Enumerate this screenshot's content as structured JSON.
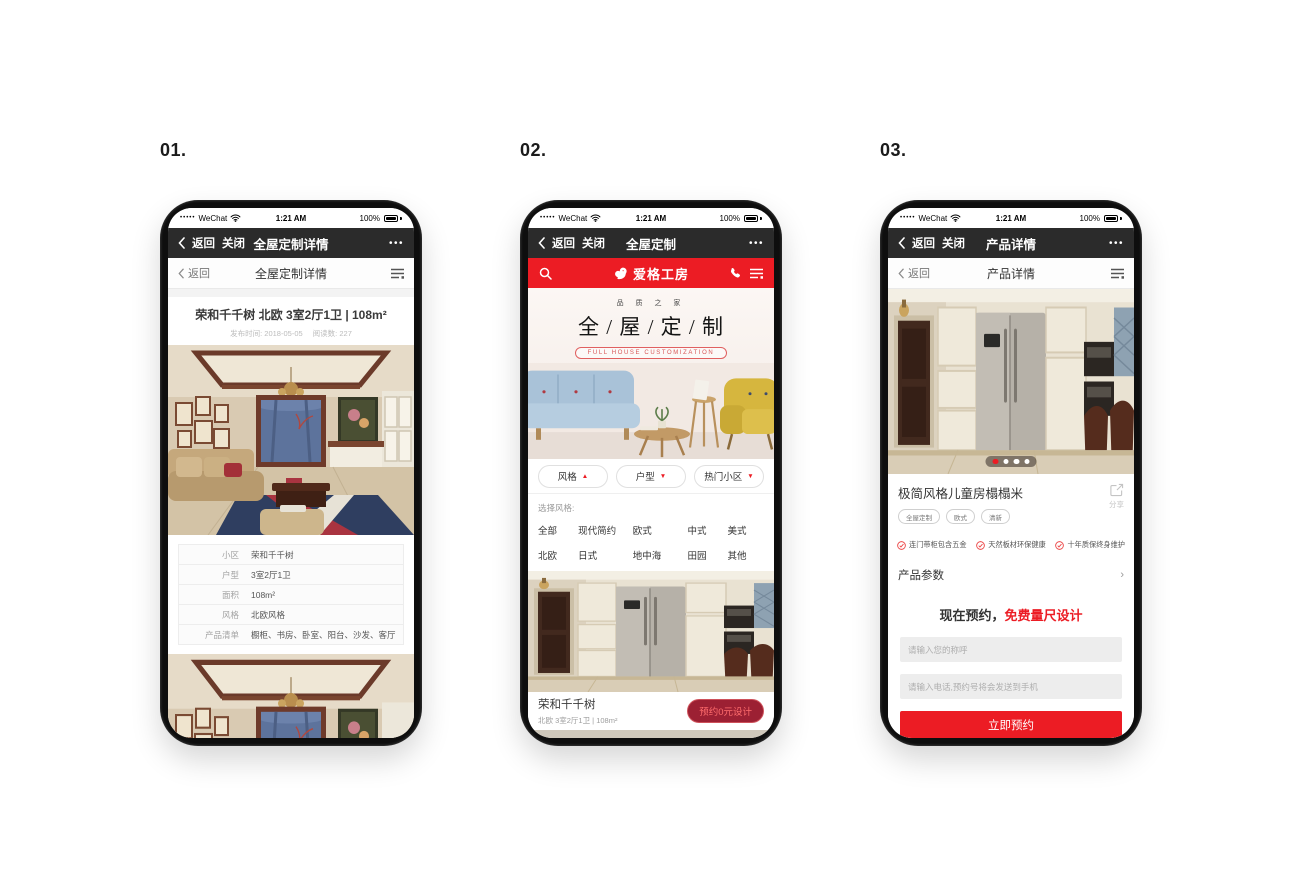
{
  "labels": {
    "phone1": "01.",
    "phone2": "02.",
    "phone3": "03."
  },
  "status_bar": {
    "signal_dots": "•••••",
    "carrier": "WeChat",
    "time": "1:21 AM",
    "battery_percent": "100%"
  },
  "icons": {
    "more": "•••",
    "chevron_right": "›"
  },
  "colors": {
    "brand_red": "#ec1c24",
    "nav_dark": "#2b2b2b",
    "deep_red": "#9c2033"
  },
  "phones": [
    {
      "wechat_nav": {
        "back": "返回",
        "close": "关闭",
        "title": "全屋定制详情"
      },
      "page_nav": {
        "back": "返回",
        "title": "全屋定制详情"
      },
      "article": {
        "title": "荣和千千树 北欧 3室2厅1卫 | 108m²",
        "publish_label": "发布时间:",
        "publish_date": "2018-05-05",
        "reads_label": "阅读数:",
        "reads_count": "227"
      },
      "info_table": {
        "rows": [
          {
            "label": "小区",
            "value": "荣和千千树"
          },
          {
            "label": "户型",
            "value": "3室2厅1卫"
          },
          {
            "label": "面积",
            "value": "108m²"
          },
          {
            "label": "风格",
            "value": "北欧风格"
          },
          {
            "label": "产品清单",
            "value": "橱柜、书房、卧室、阳台、沙发、客厅"
          }
        ]
      }
    },
    {
      "wechat_nav": {
        "back": "返回",
        "close": "关闭",
        "title": "全屋定制"
      },
      "app_header": {
        "brand": "爱格工房"
      },
      "hero": {
        "tagline": "品 质 之 家",
        "title": "全 / 屋 / 定 / 制",
        "badge": "FULL HOUSE CUSTOMIZATION"
      },
      "filters": [
        {
          "label": "风格",
          "arrow": "▲"
        },
        {
          "label": "户型",
          "arrow": "▼"
        },
        {
          "label": "热门小区",
          "arrow": "▼"
        }
      ],
      "style_picker": {
        "label": "选择风格:",
        "options": [
          "全部",
          "现代简约",
          "欧式",
          "中式",
          "美式",
          "北欧",
          "日式",
          "地中海",
          "田园",
          "其他"
        ]
      },
      "listing": {
        "name": "荣和千千树",
        "spec": "北欧 3室2厅1卫 | 108m²",
        "cta": "预约0元设计"
      }
    },
    {
      "wechat_nav": {
        "back": "返回",
        "close": "关闭",
        "title": "产品详情"
      },
      "page_nav": {
        "back": "返回",
        "title": "产品详情"
      },
      "product": {
        "title": "极简风格儿童房榻榻米",
        "share_label": "分享",
        "tags": [
          "全屋定制",
          "欧式",
          "清新"
        ],
        "features": [
          "连门带柜包含五金",
          "天然板材环保健康",
          "十年质保终身维护"
        ],
        "params_label": "产品参数"
      },
      "booking": {
        "heading_prefix": "现在预约，",
        "heading_highlight": "免费量尺设计",
        "name_placeholder": "请输入您的称呼",
        "phone_placeholder": "请输入电话,预约号将会发送到手机",
        "submit_label": "立即预约"
      }
    }
  ]
}
